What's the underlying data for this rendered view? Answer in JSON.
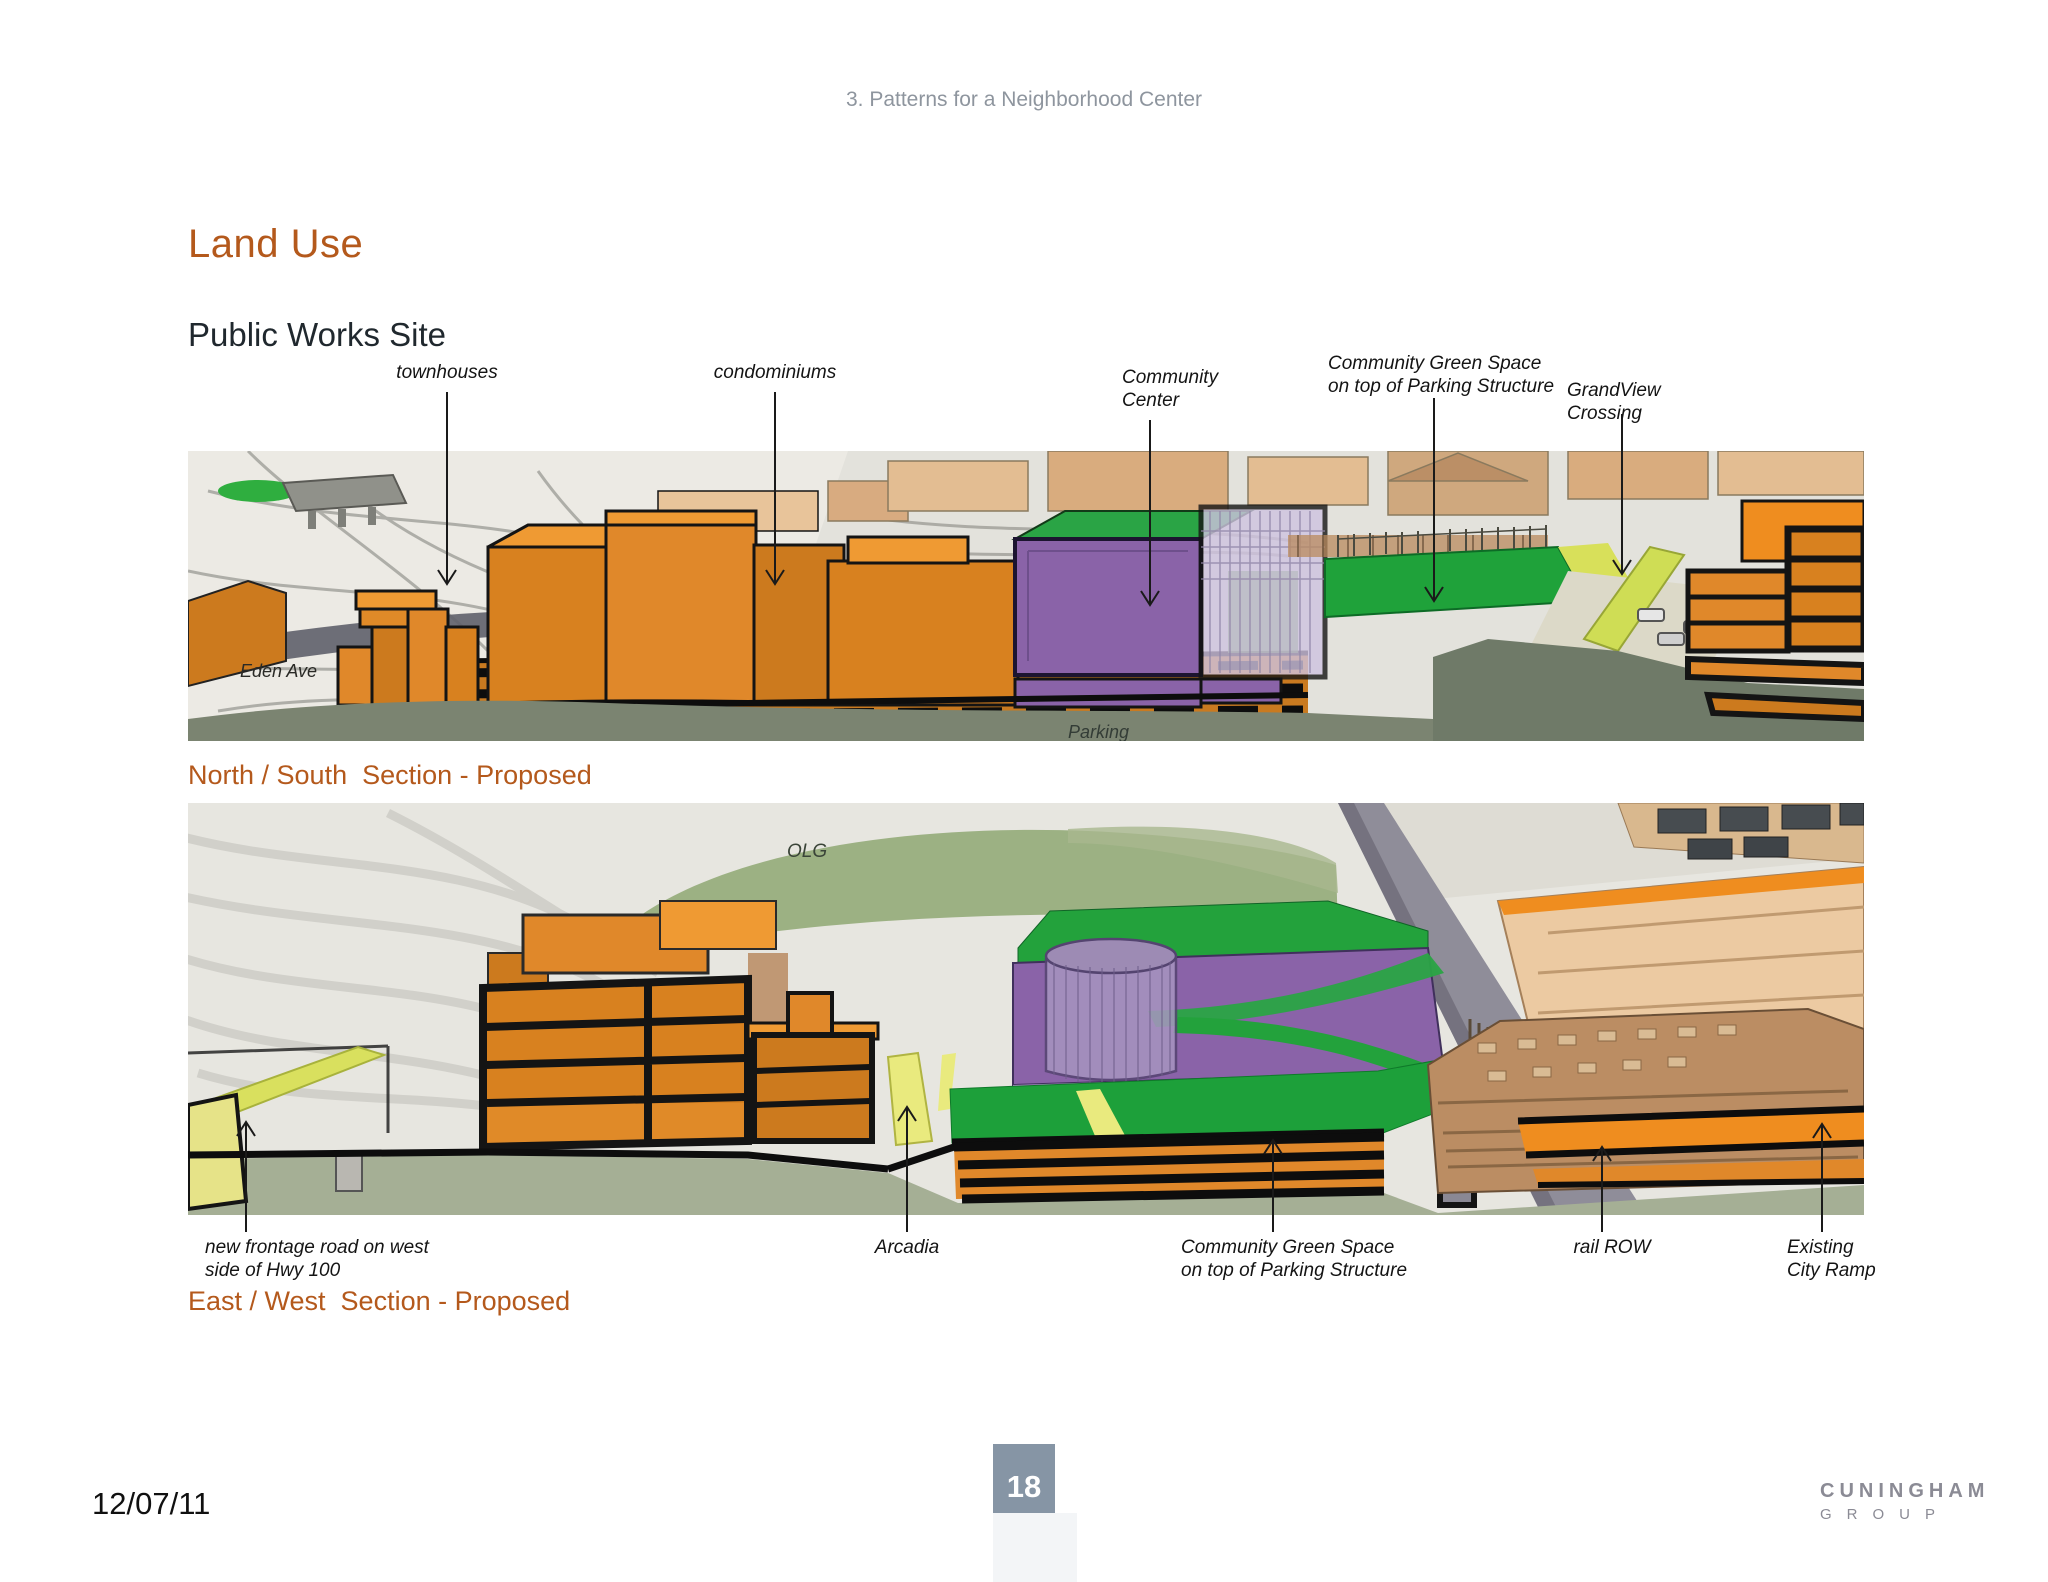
{
  "page": {
    "header": "3. Patterns for a Neighborhood Center",
    "title": "Land Use",
    "subtitle": "Public Works Site",
    "footer": {
      "date": "12/07/11",
      "page_number": "18",
      "logo_line1": "CUNINGHAM",
      "logo_line2": "GROUP"
    },
    "colors": {
      "accent_orange": "#b4591c",
      "header_gray": "#8e959e",
      "badge_blue_gray": "#8695a5",
      "logo_gray": "#8b8b95",
      "label_black": "#141414",
      "building_orange": "#e0882a",
      "community_purple": "#8a63a8",
      "green_space_green": "#1fa23a",
      "foreground_sage": "#7b8471"
    }
  },
  "figure1": {
    "caption": "North / South  Section - Proposed",
    "annotations": {
      "townhouses": "townhouses",
      "condominiums": "condominiums",
      "community_center": "Community\nCenter",
      "green_space": "Community Green Space\non top of Parking Structure",
      "grandview": "GrandView\nCrossing"
    },
    "inline_labels": {
      "eden_ave": "Eden Ave",
      "parking": "Parking"
    }
  },
  "figure2": {
    "caption": "East / West  Section - Proposed",
    "annotations": {
      "frontage_road": "new frontage road on west\nside of Hwy 100",
      "arcadia": "Arcadia",
      "green_space": "Community Green Space\non top of Parking Structure",
      "rail_row": "rail ROW",
      "city_ramp": "Existing\nCity Ramp"
    },
    "inline_labels": {
      "olg": "OLG"
    }
  }
}
